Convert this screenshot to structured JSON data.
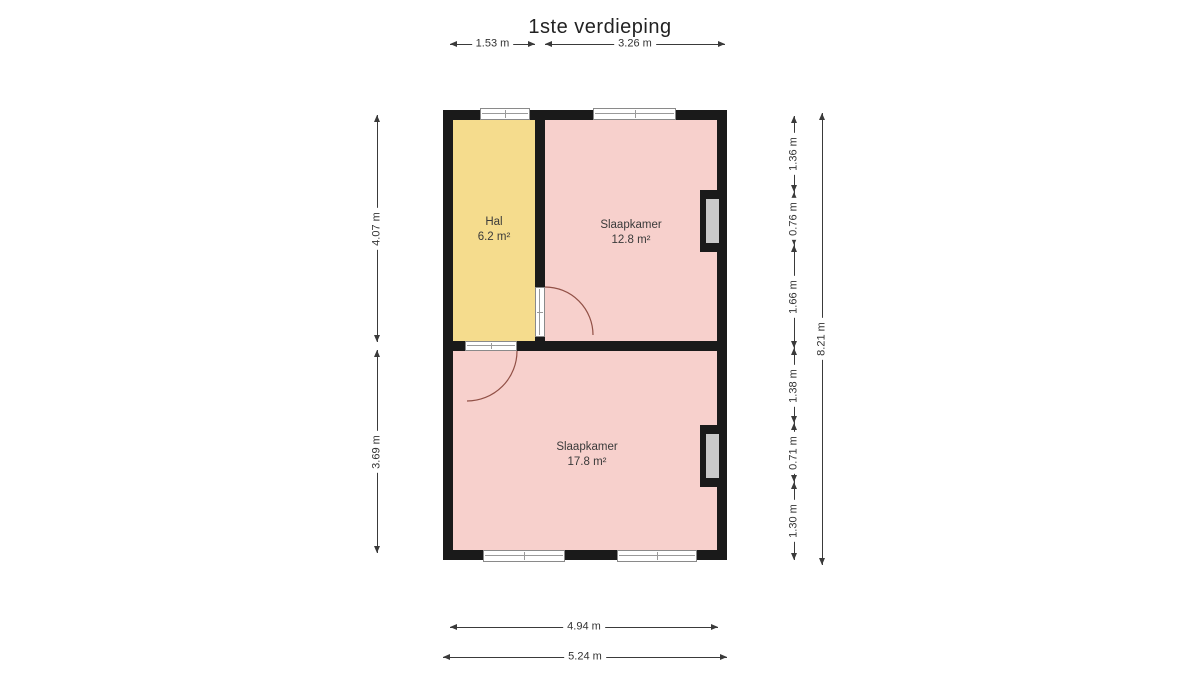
{
  "title": "1ste verdieping",
  "rooms": [
    {
      "name": "Hal",
      "area": "6.2 m²",
      "color": "#f5dc8d"
    },
    {
      "name": "Slaapkamer",
      "area": "12.8 m²",
      "color": "#f7d0cc"
    },
    {
      "name": "Slaapkamer",
      "area": "17.8 m²",
      "color": "#f7d0cc"
    }
  ],
  "dimensions": {
    "top": [
      "1.53 m",
      "3.26 m"
    ],
    "left": [
      "4.07 m",
      "3.69 m"
    ],
    "right_segments": [
      "1.36 m",
      "0.76 m",
      "1.66 m",
      "1.38 m",
      "0.71 m",
      "1.30 m"
    ],
    "right_total": "8.21 m",
    "bottom": [
      "4.94 m",
      "5.24 m"
    ]
  },
  "colors": {
    "wall": "#1a1a1a",
    "hal_fill": "#f5dc8d",
    "bedroom_fill": "#f7d0cc",
    "window_glass": "#c9c9c9",
    "door_arc": "#915046",
    "dimension_line": "#3a3a3a"
  }
}
